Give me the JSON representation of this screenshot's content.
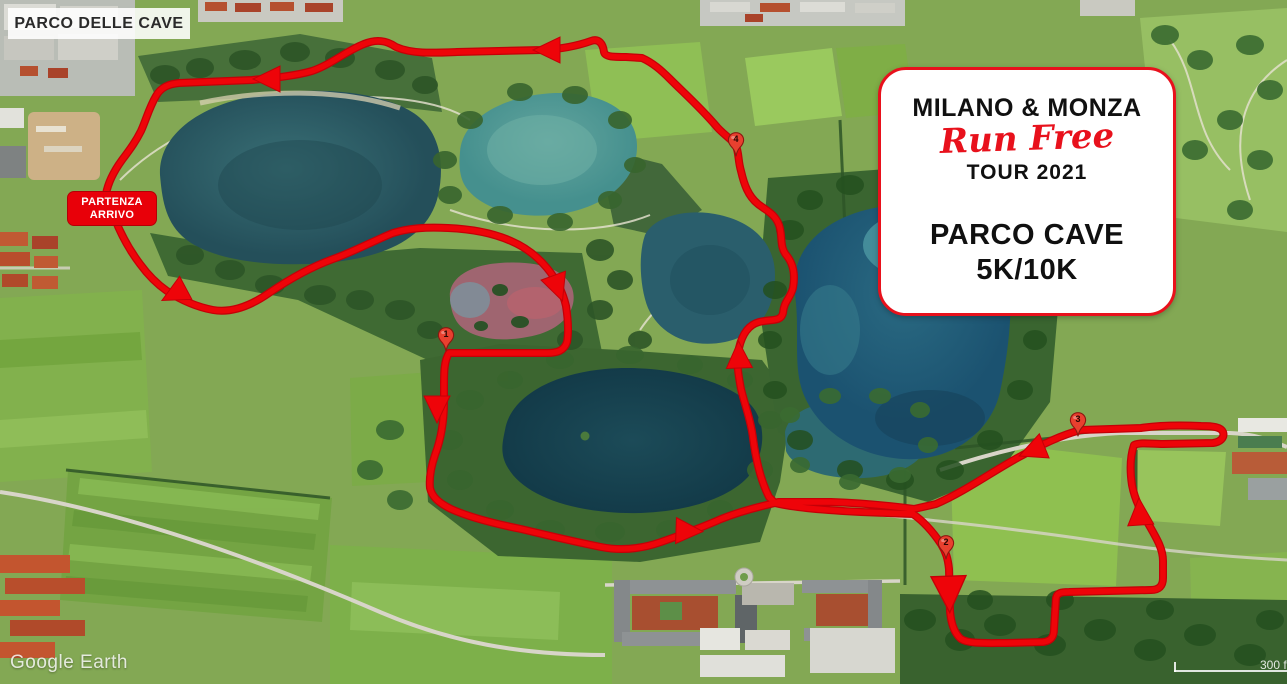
{
  "map": {
    "area_label": "PARCO DELLE CAVE",
    "watermark": "Google Earth",
    "scale_bar_label": "300 f"
  },
  "start_finish": {
    "line1": "PARTENZA",
    "line2": "ARRIVO"
  },
  "route": {
    "color": "#ee0409",
    "markers": [
      {
        "label": "1"
      },
      {
        "label": "2"
      },
      {
        "label": "3"
      },
      {
        "label": "4"
      }
    ]
  },
  "info_card": {
    "title": "MILANO & MONZA",
    "script_line": "Run Free",
    "tour_line": "TOUR 2021",
    "course_name": "PARCO CAVE",
    "distances": "5K/10K",
    "accent_color": "#e8111c"
  }
}
